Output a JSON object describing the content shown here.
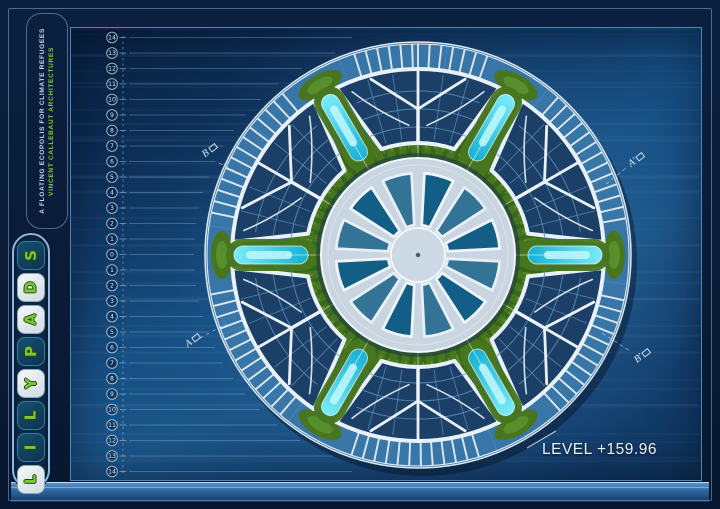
{
  "header": {
    "subtitle": "A FLOATING ECOPOLIS FOR CLIMATE REFUGEES",
    "firm": "VINCENT CALLEBAUT ARCHITECTURES"
  },
  "logo": {
    "word": "LILYPADS",
    "tiles": [
      {
        "letter": "S",
        "style": "dark"
      },
      {
        "letter": "D",
        "style": "light"
      },
      {
        "letter": "A",
        "style": "light"
      },
      {
        "letter": "P",
        "style": "dark"
      },
      {
        "letter": "Y",
        "style": "light"
      },
      {
        "letter": "L",
        "style": "dark"
      },
      {
        "letter": "I",
        "style": "dark"
      },
      {
        "letter": "L",
        "style": "light"
      }
    ],
    "accent_green": "#7dc832"
  },
  "ruler": {
    "labels": [
      "14",
      "13",
      "12",
      "11",
      "10",
      "9",
      "8",
      "7",
      "6",
      "5",
      "4",
      "3",
      "2",
      "1",
      "0",
      "1",
      "2",
      "3",
      "4",
      "5",
      "6",
      "7",
      "8",
      "9",
      "10",
      "11",
      "12",
      "13",
      "14"
    ]
  },
  "plan": {
    "level_label": "LEVEL +159.96",
    "section_markers": [
      {
        "label": "B"
      },
      {
        "label": "A'"
      },
      {
        "label": "A"
      },
      {
        "label": "B'"
      }
    ],
    "colors": {
      "ocean": "#175084",
      "island_base": "#2d689c",
      "structure_white": "#e9f1f8",
      "glass_dark": "#1b3f66",
      "glass_grid": "#5d8fb6",
      "glass_teal": "#2391b8",
      "lagoon_cyan": "#2fd4ea",
      "lagoon_light": "#c2f8fd",
      "vegetation_green": "#47761f",
      "vegetation_dark": "#35611a",
      "hub_deck": "#c9d5e1"
    }
  }
}
